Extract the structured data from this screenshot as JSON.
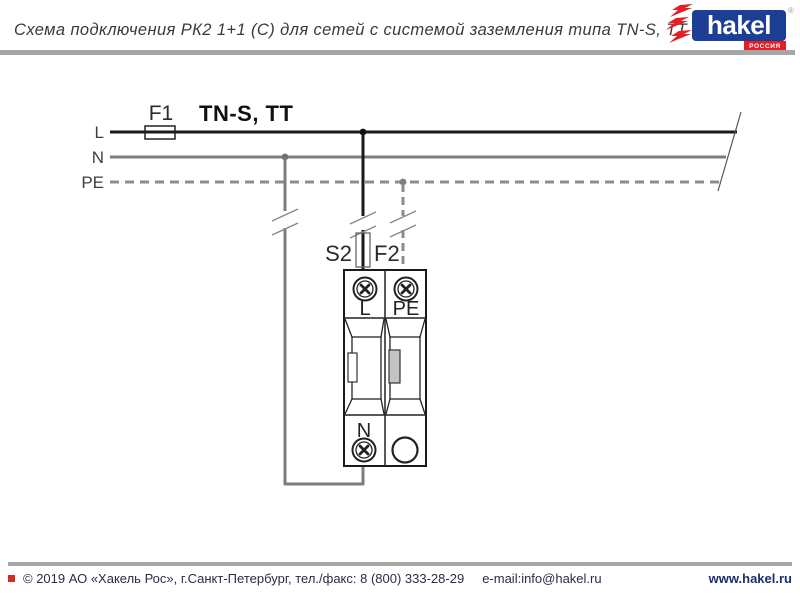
{
  "header": {
    "title": "Схема подключения РК2 1+1 (С) для сетей с системой заземления типа TN-S, TT"
  },
  "logo": {
    "brand": "hakel",
    "registered": "®",
    "region": "РОССИЯ",
    "blue": "#1c3e94",
    "red": "#e31e24"
  },
  "diagram": {
    "system_label": "TN-S, TT",
    "bus_l": "L",
    "bus_n": "N",
    "bus_pe": "PE",
    "fuse_f1": "F1",
    "switch_s2": "S2",
    "fuse_f2": "F2",
    "device": {
      "terminal_l": "L",
      "terminal_pe": "PE",
      "terminal_n": "N"
    },
    "colors": {
      "line_l": "#1a1a1a",
      "line_n": "#7d7d7d",
      "line_pe": "#8c8c8c"
    }
  },
  "footer": {
    "copyright": "© 2019 АО «Хакель Рос», г.Санкт-Петербург, тел./факс: 8 (800) 333-28-29",
    "email": "e-mail:info@hakel.ru",
    "website": "www.hakel.ru"
  }
}
